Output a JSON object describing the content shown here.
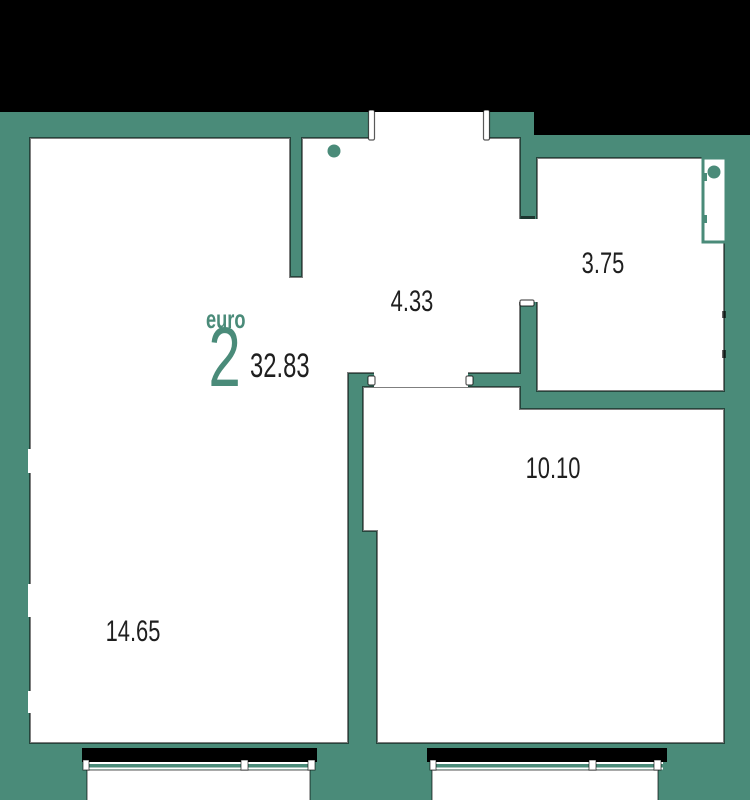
{
  "unit": {
    "plan_type_label": "euro",
    "rooms_count": "2",
    "total_area": "32.83"
  },
  "room_areas": {
    "hallway": "4.33",
    "bathroom": "3.75",
    "kitchen_living": "10.10",
    "living_room": "14.65"
  },
  "colors": {
    "wall_teal": "#4a8b79",
    "exterior_mask_black": "#000000",
    "room_fill_white": "#ffffff",
    "area_text_dark": "#1f1f1f"
  }
}
